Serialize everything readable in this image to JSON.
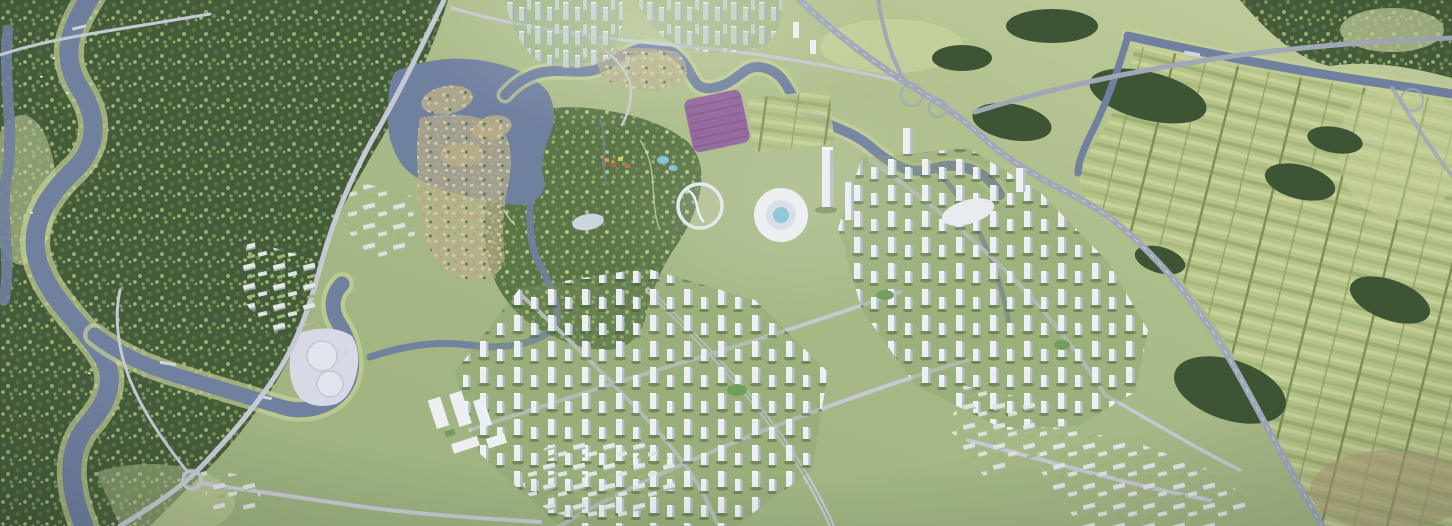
{
  "scene": {
    "type": "aerial-masterplan-render",
    "description": "Bird's-eye architectural rendering of an eco-city masterplan: dense forest and winding rivers on the west, a heritage water town and central park in the middle, a lavender flower field, clusters of white residential towers around a circular civic landmark, an expressway interchange, and striped farmland to the east.",
    "regions": [
      {
        "name": "west-forest",
        "label": "dense forest"
      },
      {
        "name": "west-river",
        "label": "winding river with boats"
      },
      {
        "name": "heritage-village",
        "label": "tan heritage water-town"
      },
      {
        "name": "central-park",
        "label": "central green park with creeks"
      },
      {
        "name": "lavender-field",
        "label": "purple flower field"
      },
      {
        "name": "civic-landmark",
        "label": "circular white civic complex with pool"
      },
      {
        "name": "city-towers",
        "label": "white high-rise residential clusters"
      },
      {
        "name": "twin-circle-plaza",
        "label": "pale plaza with two circular basins"
      },
      {
        "name": "expressway",
        "label": "expressway with interchange"
      },
      {
        "name": "farmland",
        "label": "striped crop fields with tree rows"
      }
    ]
  },
  "palette": {
    "meadow": "#a8bb85",
    "meadowLight": "#c0cd96",
    "lawn": "#c8d49c",
    "forest1": "#445c39",
    "forest2": "#7e9a5c",
    "park1": "#5a7547",
    "treeDark": "#3c5433",
    "water": "#6f80a1",
    "waterHi": "#94a3be",
    "bank": "#c6d294",
    "plaza": "#d8dbe7",
    "road": "#c6cad4",
    "highway": "#a0a8b8",
    "towerWhite": "#eef1f4",
    "towerShade": "#b6c1cc",
    "towerShadow": "#3e5434",
    "glassA": "#c6d2cc",
    "glassB": "#9db0ac",
    "oldA": "#d8c7a1",
    "oldB": "#bda57c",
    "lavender": "#92639d",
    "lavenderRow": "#7a4f86",
    "farmA": "#b6c487",
    "farmB": "#9fb172",
    "farmC": "#c9d395",
    "farmD": "#a9bb7d",
    "farmBrown": "#b19f77",
    "pool": "#7fc3d6",
    "haze": "#f2f5f7"
  }
}
